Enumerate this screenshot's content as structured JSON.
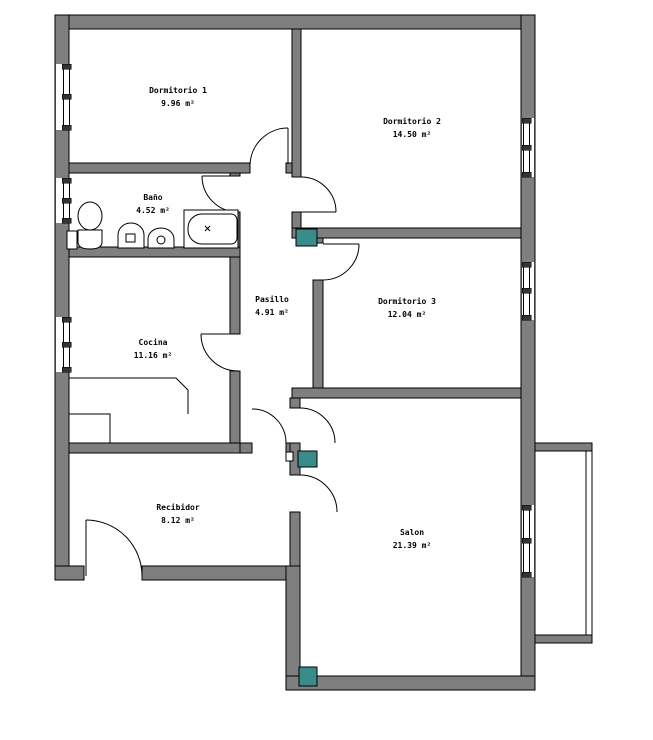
{
  "title": "Floor plan",
  "colors": {
    "wall": "#7f7f7f",
    "accent": "#3a8b8b",
    "line": "#000000",
    "background": "#ffffff",
    "text": "#000000"
  },
  "rooms": [
    {
      "name": "Dormitorio 1",
      "area": "9.96 m²"
    },
    {
      "name": "Dormitorio 2",
      "area": "14.50 m²"
    },
    {
      "name": "Dormitorio 3",
      "area": "12.04 m²"
    },
    {
      "name": "Baño",
      "area": "4.52 m²"
    },
    {
      "name": "Cocina",
      "area": "11.16 m²"
    },
    {
      "name": "Pasillo",
      "area": "4.91 m²"
    },
    {
      "name": "Recibidor",
      "area": "8.12 m²"
    },
    {
      "name": "Salon",
      "area": "21.39 m²"
    }
  ]
}
